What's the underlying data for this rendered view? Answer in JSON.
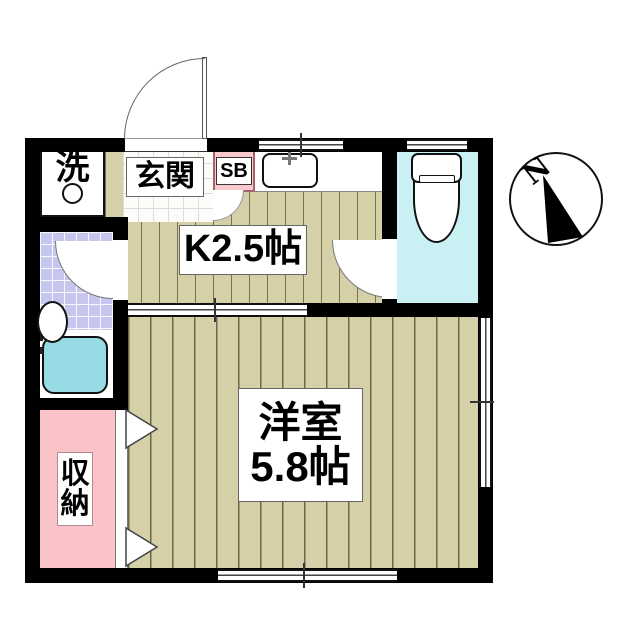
{
  "floorplan": {
    "labels": {
      "laundry": "洗",
      "entrance": "玄関",
      "shoe_box": "SB",
      "kitchen": "K2.5帖",
      "main_room_name": "洋室",
      "main_room_size": "5.8帖",
      "storage_char1": "収",
      "storage_char2": "納"
    },
    "compass": {
      "north": "N"
    },
    "colors": {
      "wall": "#000000",
      "wood_floor": "#d6d0a8",
      "floor_stripe": "#6b684a",
      "bathroom_tile": "#c6c6ee",
      "toilet_room": "#c9f1f3",
      "bathtub": "#96dbe4",
      "storage": "#f9c3c8",
      "shoe_box_fill": "#f8c9cd"
    }
  }
}
